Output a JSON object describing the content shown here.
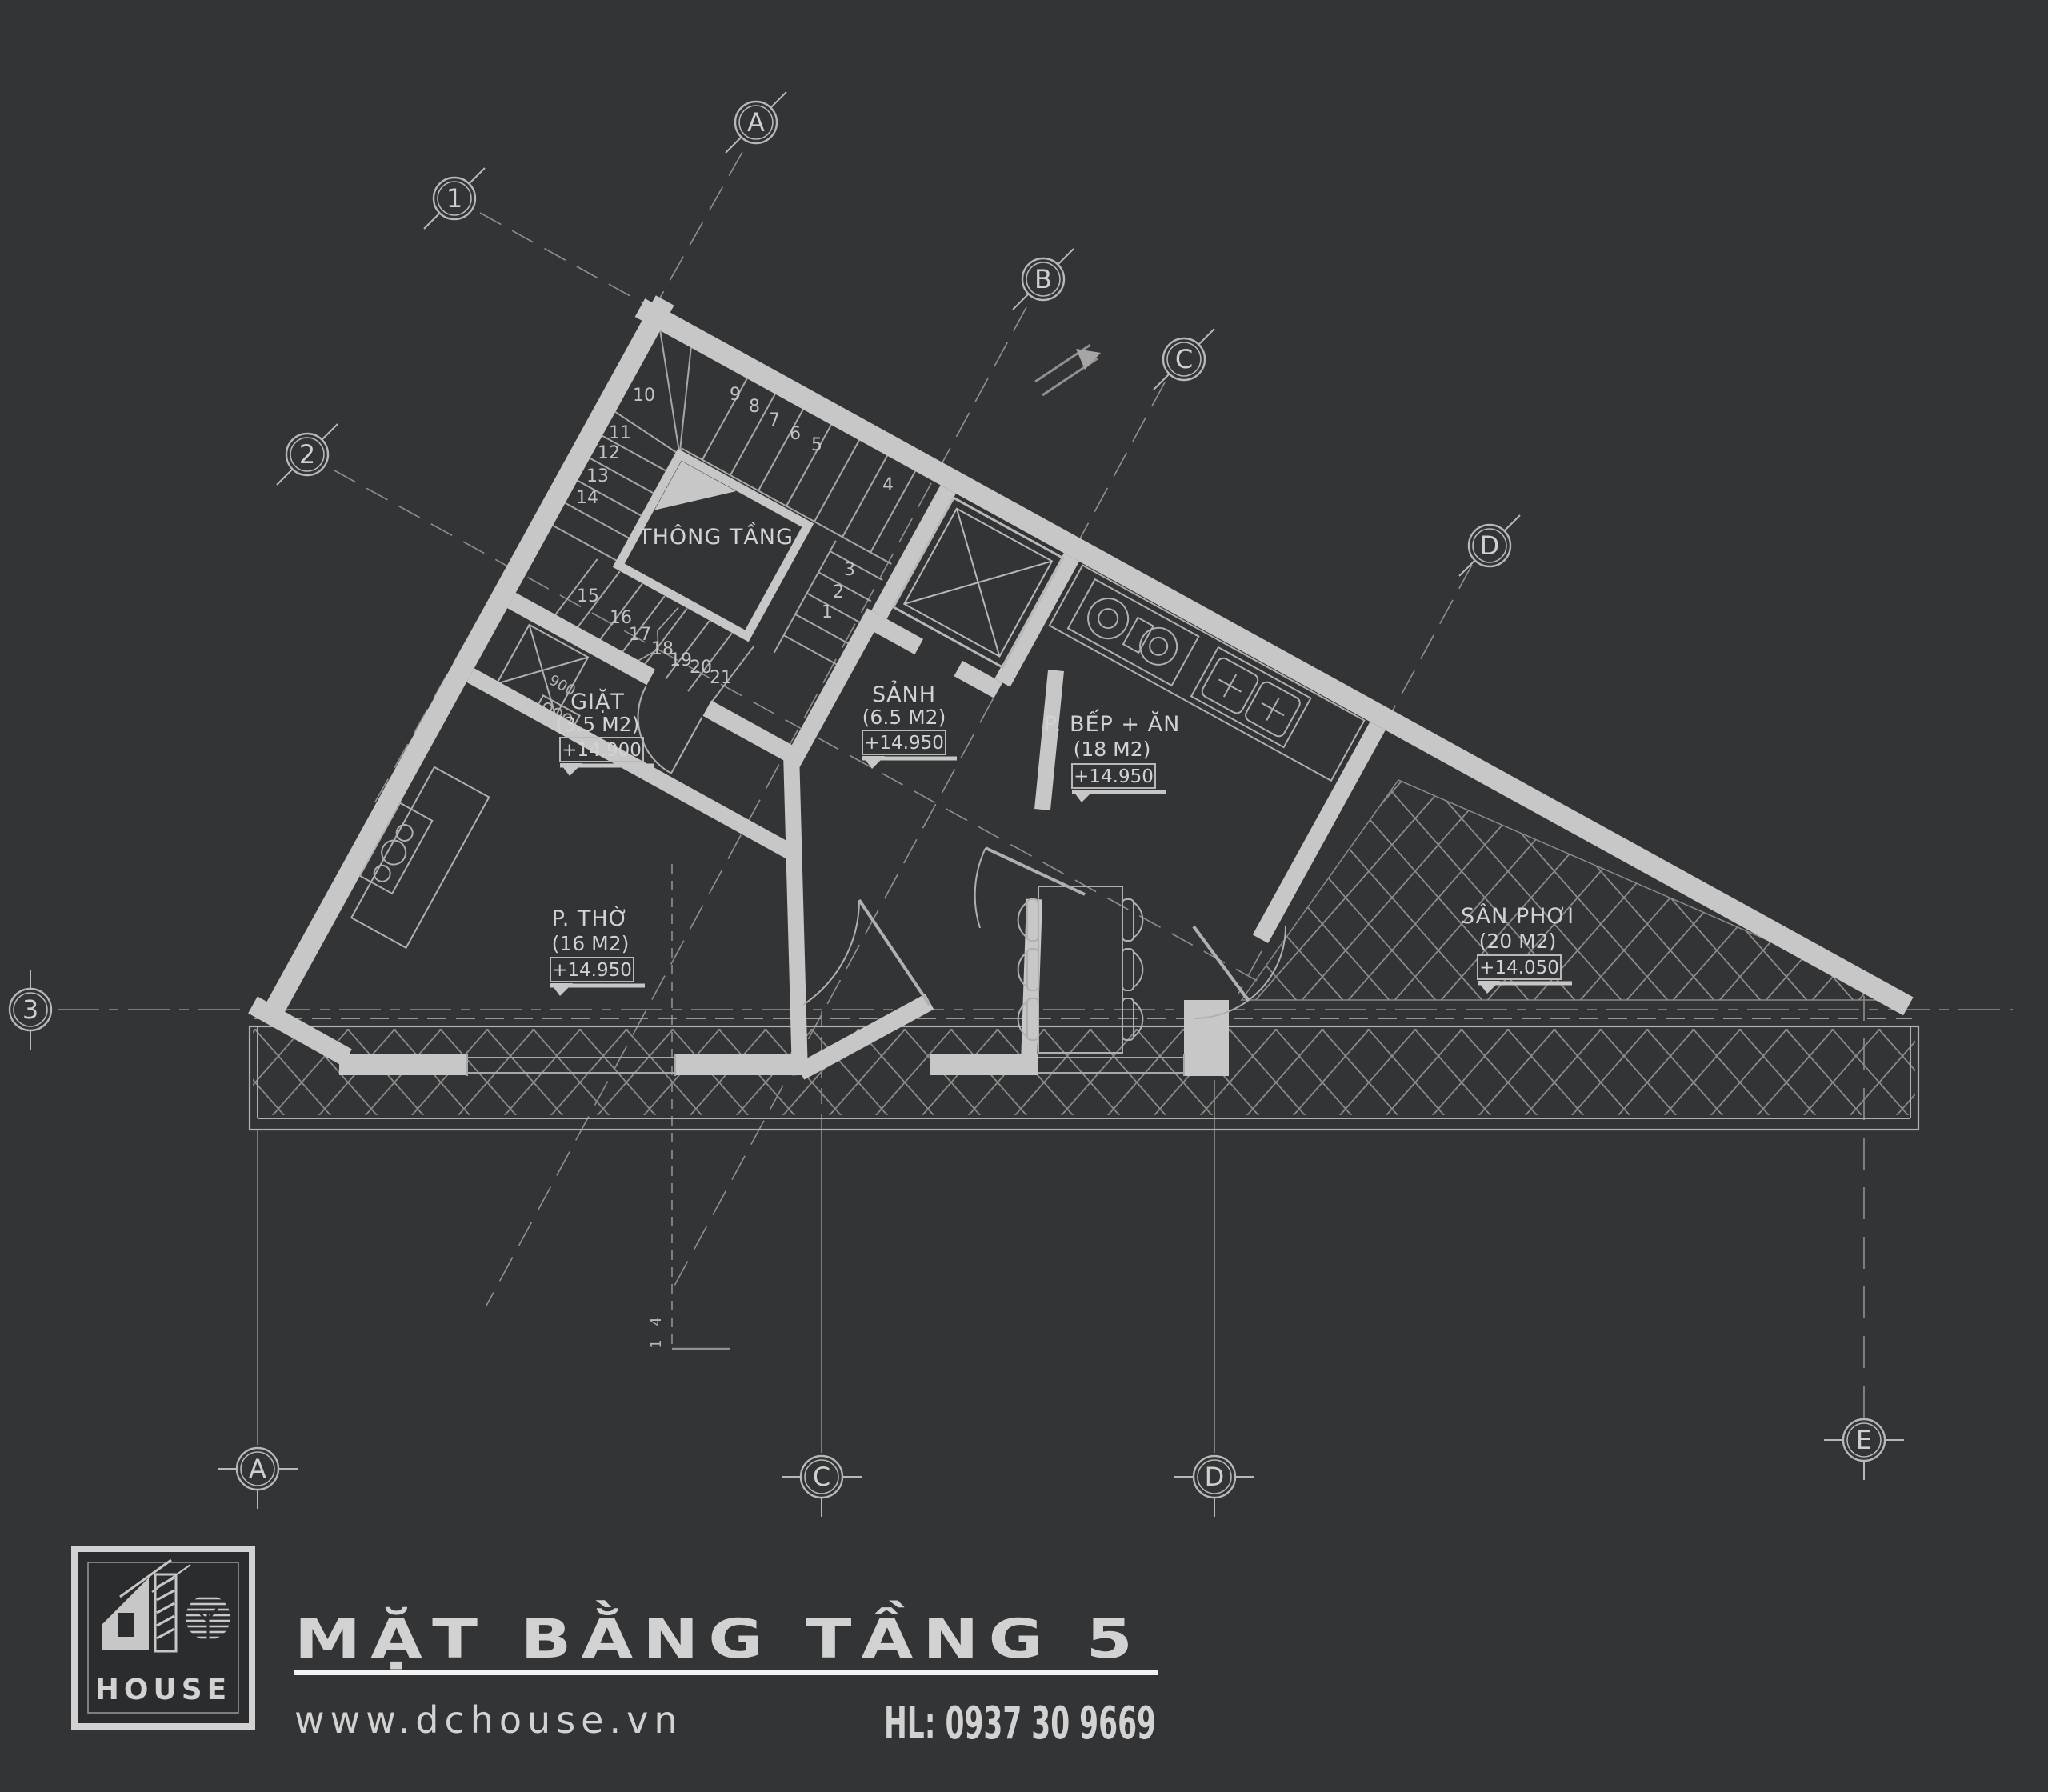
{
  "colors": {
    "background": "#333436",
    "wall": "#c7c7c7",
    "line": "#b0b0b0",
    "thin": "#989898",
    "hatch": "#8a8a8a",
    "text": "#d2d2d2",
    "white": "#f4f4f4"
  },
  "title_block": {
    "title": "MẶT BẰNG TẦNG 5",
    "website": "www.dchouse.vn",
    "hotline": "HL: 0937 30 9669",
    "logo_text": "HOUSE"
  },
  "rooms": {
    "void": {
      "name": "THÔNG TẦNG"
    },
    "laundry": {
      "name": "GIẶT",
      "area": "(3.5 M2)",
      "level": "+14.900"
    },
    "hall": {
      "name": "SẢNH",
      "area": "(6.5 M2)",
      "level": "+14.950"
    },
    "kitchen": {
      "name": "P. BẾP + ĂN",
      "area": "(18 M2)",
      "level": "+14.950"
    },
    "worship": {
      "name": "P. THỜ",
      "area": "(16 M2)",
      "level": "+14.950"
    },
    "yard": {
      "name": "SÂN PHƠI",
      "area": "(20 M2)",
      "level": "+14.050"
    }
  },
  "grid_markers": {
    "g1": "1",
    "g2": "2",
    "g3": "3",
    "a_top": "A",
    "b_top": "B",
    "c_top": "C",
    "d_top": "D",
    "a_bot": "A",
    "c_bot": "C",
    "d_bot": "D",
    "e_bot": "E"
  },
  "stairs": {
    "numbers": [
      "1",
      "2",
      "3",
      "4",
      "5",
      "6",
      "7",
      "8",
      "9",
      "10",
      "11",
      "12",
      "13",
      "14",
      "15",
      "16",
      "17",
      "18",
      "19",
      "20",
      "21"
    ]
  },
  "annotations": {
    "section_top": "4",
    "section_bottom": "1",
    "dim": "900"
  }
}
